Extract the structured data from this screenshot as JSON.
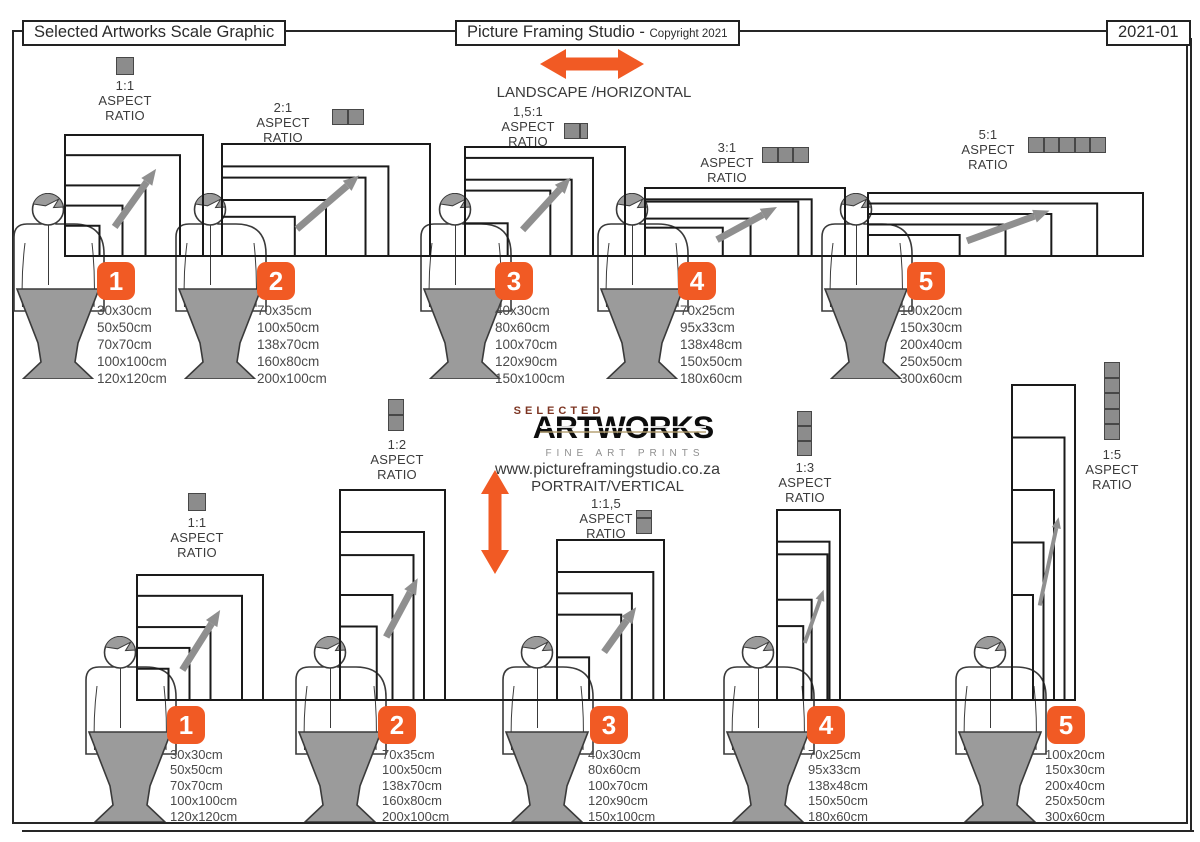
{
  "header": {
    "left_title": "Selected Artworks Scale Graphic",
    "center_title": "Picture Framing Studio -",
    "center_copyright": "Copyright 2021",
    "doc_number": "2021-01"
  },
  "sections": {
    "landscape_label": "LANDSCAPE /HORIZONTAL",
    "portrait_label": "PORTRAIT/VERTICAL"
  },
  "logo": {
    "top": "SELECTED",
    "name": "ARTWORKS",
    "subtitle": "FINE ART PRINTS",
    "website": "www.pictureframingstudio.co.za"
  },
  "labels": {
    "aspect": "ASPECT",
    "ratio": "RATIO"
  },
  "colors": {
    "accent_orange": "#F15A24",
    "figure_gray": "#9B9B9B",
    "icon_gray": "#8C8C8C",
    "frame_stroke": "#1A1A1A",
    "logo_red": "#7D3522"
  },
  "groups": {
    "landscape": [
      {
        "number": "1",
        "ratio": "1:1",
        "cells": 1,
        "sizes": [
          "30x30cm",
          "50x50cm",
          "70x70cm",
          "100x100cm",
          "120x120cm"
        ]
      },
      {
        "number": "2",
        "ratio": "2:1",
        "cells": 2,
        "sizes": [
          "70x35cm",
          "100x50cm",
          "138x70cm",
          "160x80cm",
          "200x100cm"
        ]
      },
      {
        "number": "3",
        "ratio": "1,5:1",
        "cells": 1.5,
        "sizes": [
          "40x30cm",
          "80x60cm",
          "100x70cm",
          "120x90cm",
          "150x100cm"
        ]
      },
      {
        "number": "4",
        "ratio": "3:1",
        "cells": 3,
        "sizes": [
          "70x25cm",
          "95x33cm",
          "138x48cm",
          "150x50cm",
          "180x60cm"
        ]
      },
      {
        "number": "5",
        "ratio": "5:1",
        "cells": 5,
        "sizes": [
          "100x20cm",
          "150x30cm",
          "200x40cm",
          "250x50cm",
          "300x60cm"
        ]
      }
    ],
    "portrait": [
      {
        "number": "1",
        "ratio": "1:1",
        "cells": 1,
        "sizes": [
          "30x30cm",
          "50x50cm",
          "70x70cm",
          "100x100cm",
          "120x120cm"
        ]
      },
      {
        "number": "2",
        "ratio": "1:2",
        "cells": 2,
        "sizes": [
          "70x35cm",
          "100x50cm",
          "138x70cm",
          "160x80cm",
          "200x100cm"
        ]
      },
      {
        "number": "3",
        "ratio": "1:1,5",
        "cells": 1.5,
        "sizes": [
          "40x30cm",
          "80x60cm",
          "100x70cm",
          "120x90cm",
          "150x100cm"
        ]
      },
      {
        "number": "4",
        "ratio": "1:3",
        "cells": 3,
        "sizes": [
          "70x25cm",
          "95x33cm",
          "138x48cm",
          "150x50cm",
          "180x60cm"
        ]
      },
      {
        "number": "5",
        "ratio": "1:5",
        "cells": 5,
        "sizes": [
          "100x20cm",
          "150x30cm",
          "200x40cm",
          "250x50cm",
          "300x60cm"
        ]
      }
    ]
  }
}
